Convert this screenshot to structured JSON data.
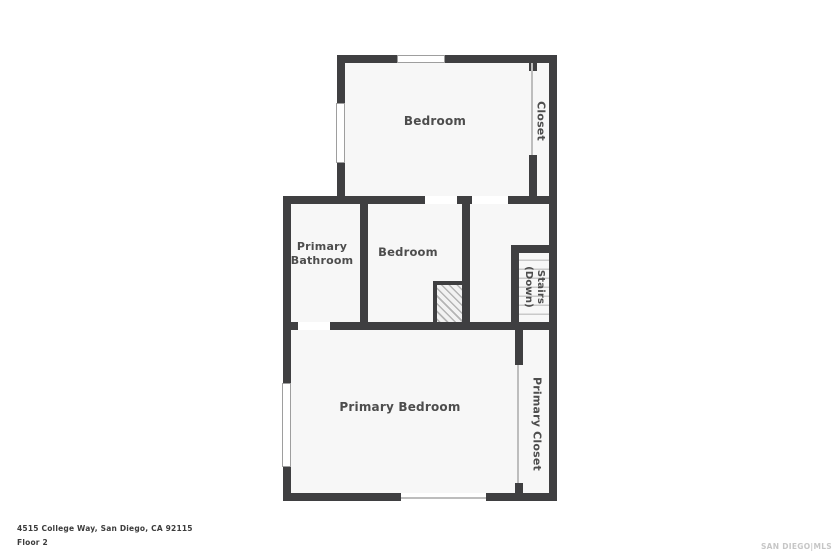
{
  "rooms": {
    "bedroom_top": "Bedroom",
    "closet": "Closet",
    "primary_bathroom": "Primary Bathroom",
    "bedroom_middle": "Bedroom",
    "stairs": "Stairs (Down)",
    "primary_bedroom": "Primary Bedroom",
    "primary_closet": "Primary Closet"
  },
  "footer": {
    "address": "4515 College Way, San Diego, CA 92115",
    "floor": "Floor 2"
  },
  "watermark": "SAN DIEGO|MLS",
  "colors": {
    "wall": "#3f3f41",
    "room_fill": "#f7f7f7",
    "label": "#4d4d4d",
    "window_border": "#9e9e9e",
    "watermark": "#c6c6c6"
  }
}
